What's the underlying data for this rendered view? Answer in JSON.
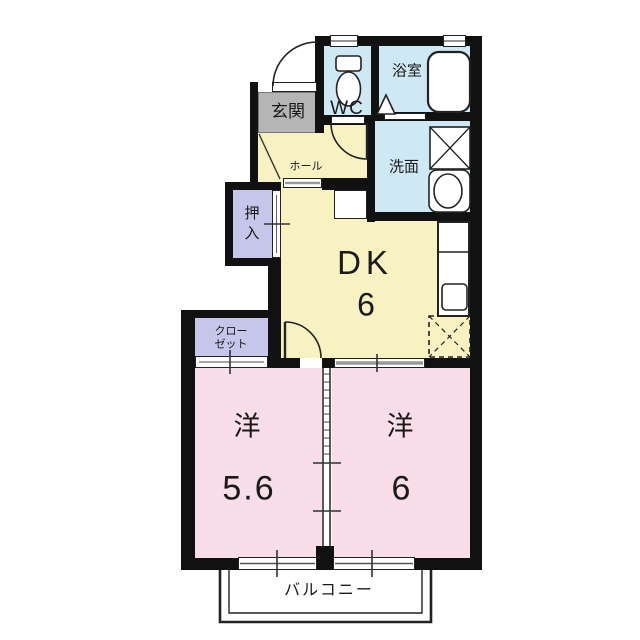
{
  "document": {
    "type": "floor-plan",
    "layout_name": "2DK"
  },
  "rooms": {
    "genkan": {
      "label": "玄関"
    },
    "wc": {
      "label": "WC"
    },
    "bath": {
      "label": "浴室"
    },
    "washroom": {
      "label": "洗面"
    },
    "hall": {
      "label": "ホール"
    },
    "oshiire": {
      "label": "押入",
      "line1": "押",
      "line2": "入"
    },
    "dk": {
      "label": "DK",
      "size": "6"
    },
    "closet": {
      "label": "クローゼット",
      "line1": "クロー",
      "line2": "ゼット"
    },
    "western1": {
      "label": "洋",
      "size": "5.6"
    },
    "western2": {
      "label": "洋",
      "size": "6"
    },
    "balcony": {
      "label": "バルコニー"
    }
  },
  "icons": {
    "toilet": "toilet-icon",
    "bathtub": "bathtub-icon",
    "bath_door_triangle": "bath-door-triangle-icon",
    "washing_machine": "washing-machine-pan-icon",
    "vanity_sink": "vanity-sink-icon",
    "kitchen_sink": "kitchen-sink-icon",
    "refrigerator_space": "refrigerator-space-icon"
  },
  "colors": {
    "wall": "#111111",
    "dk_fill": "#f8f1c2",
    "bedroom_fill": "#f9dde8",
    "wet_fill": "#cfe9f4",
    "closet_fill": "#c6c6ea",
    "genkan_fill": "#b5b5b5"
  }
}
